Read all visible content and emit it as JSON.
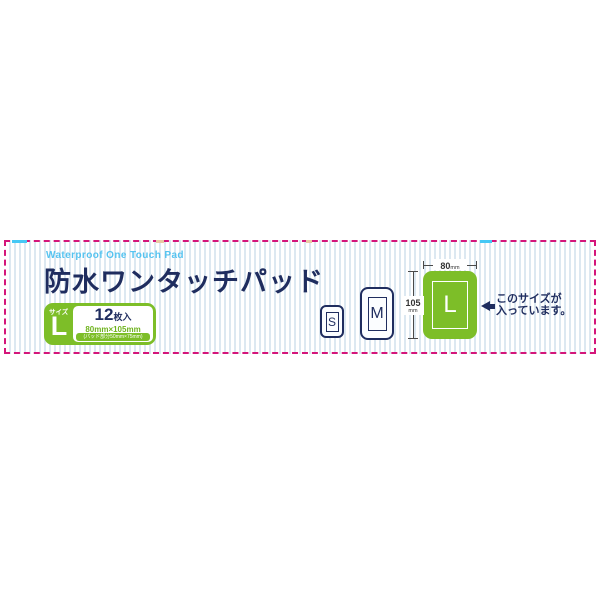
{
  "label": {
    "subtitle_en": "Waterproof One Touch Pad",
    "title_ja": "防水ワンタッチパッド",
    "size_badge": {
      "size_label": "サイズ",
      "size_value": "L",
      "count": "12",
      "count_unit": "枚入",
      "dimensions": "80mm×105mm",
      "pad_note": "(パッド部分50mm×75mm)"
    },
    "size_icons": [
      {
        "letter": "S",
        "highlighted": false
      },
      {
        "letter": "M",
        "highlighted": false
      },
      {
        "letter": "L",
        "highlighted": true
      }
    ],
    "dimension_width": {
      "value": "80",
      "unit": "mm"
    },
    "dimension_height": {
      "value": "105",
      "unit": "mm"
    },
    "callout": {
      "line1": "このサイズが",
      "line2": "入っています。"
    }
  },
  "colors": {
    "border_magenta": "#d4157a",
    "accent_cyan": "#45c8f5",
    "brand_navy": "#1f2d5f",
    "brand_lightblue": "#55c3f0",
    "brand_green": "#7dbe28",
    "stripe_blue": "#dce8f1"
  }
}
